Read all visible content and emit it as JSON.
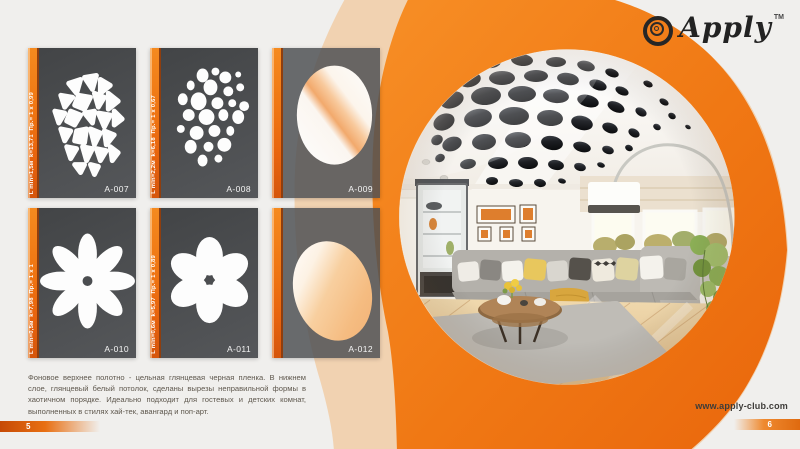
{
  "brand": {
    "name": "Apply",
    "tm": "TM",
    "logo_icon": "concentric-circles"
  },
  "website": "www.apply-club.com",
  "pagination": {
    "left": "5",
    "right": "6"
  },
  "description": "Фоновое верхнее полотно - цельная глянцевая черная пленка. В нижнем слое, глянцевый белый потолок, сделаны вырезы неправильной формы в хаотичном порядке. Идеально подходит для гостевых и детских комнат, выполненных в стилях хай-тек, авангард и поп-арт.",
  "cards": [
    {
      "id": "A-007",
      "spec": "L min=1,5м  k=13,71  Пр.= 1 x 0,99",
      "pattern": "pebble-mosaic"
    },
    {
      "id": "A-008",
      "spec": "L min=2,2м  k=6,18  Пр.= 1 x 0,67",
      "pattern": "scattered-dots"
    },
    {
      "id": "A-009",
      "spec": "",
      "pattern": "oval-window"
    },
    {
      "id": "A-010",
      "spec": "L min=0,5м  k=7,98  Пр.= 1 x 1",
      "pattern": "daisy-8-petal"
    },
    {
      "id": "A-011",
      "spec": "L min=0,6м  k=5,97  Пр.= 1 x 0,89",
      "pattern": "flower-6-petal"
    },
    {
      "id": "A-012",
      "spec": "",
      "pattern": "egg-window"
    }
  ],
  "colors": {
    "accent": "#EE7211",
    "accent_dark": "#D5550B",
    "pale": "#F3B97F",
    "card_bg": "#4B4D50",
    "page_bg": "#F0EFED"
  }
}
